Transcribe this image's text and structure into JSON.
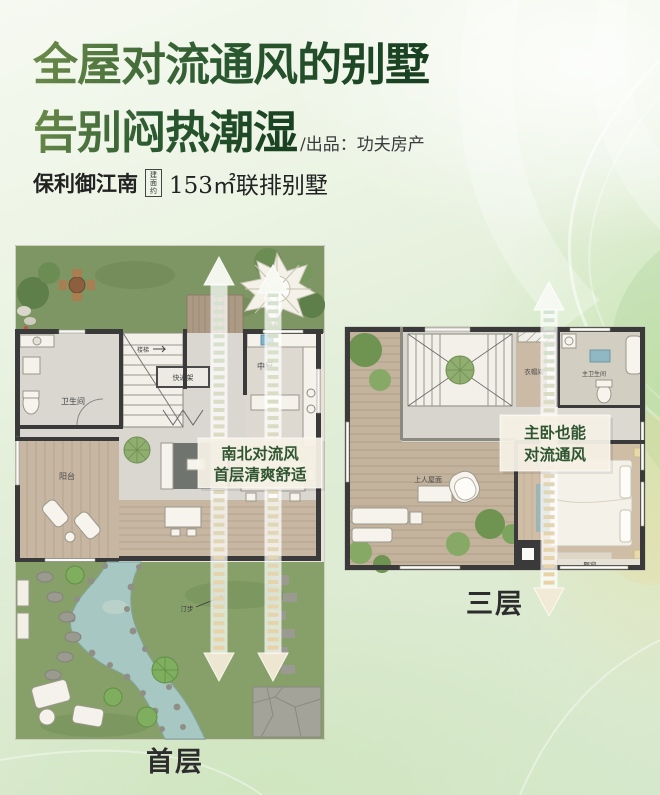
{
  "header": {
    "title_line1": "全屋对流通风的别墅",
    "title_line2": "告别闷热潮湿",
    "byline": "/出品：功夫房产",
    "project_name": "保利御江南",
    "area_badge": "建面约",
    "area_text": "153㎡联排别墅"
  },
  "first_floor": {
    "caption": "首层",
    "callout": {
      "line1": "南北对流风",
      "line2": "首层清爽舒适"
    },
    "rooms": {
      "bathroom": "卫生间",
      "stairs": "楼梯",
      "storage": "快递架",
      "kitchen": "中厨",
      "balcony": "阳台",
      "living": "会客厅",
      "stepping_stones": "汀步"
    }
  },
  "third_floor": {
    "caption": "三层",
    "callout": {
      "line1": "主卧也能",
      "line2": "对流通风"
    },
    "rooms": {
      "terrace": "上人屋面",
      "cloakroom": "衣帽间",
      "master_bath": "主卫生间",
      "bay_window": "飘窗"
    }
  },
  "colors": {
    "title_green_dark": "#1e4b28",
    "title_green_light": "#6d8c4b",
    "callout_text": "#2f5631",
    "callout_bg": "#f7f1e5",
    "arrow_green": "#d4e4d2",
    "arrow_beige": "#e9d2a4",
    "lawn_green": "#7d9663",
    "pond_blue": "#a7c7c2"
  }
}
